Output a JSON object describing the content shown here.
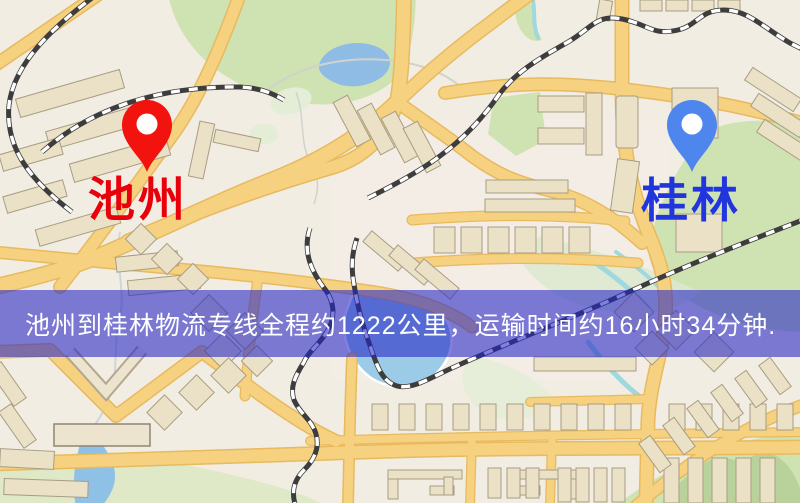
{
  "map": {
    "pins": [
      {
        "id": "origin",
        "label": "池州",
        "pin_color": "#f2130e",
        "label_color": "#e8000b"
      },
      {
        "id": "destination",
        "label": "桂林",
        "pin_color": "#4e86ee",
        "label_color": "#2135dd"
      }
    ],
    "palette": {
      "background": "#f2ede3",
      "road_fill": "#f6d180",
      "road_border": "#e7ba60",
      "park": "#cfe2b2",
      "water": "#8fbce4",
      "building": "#eae1c6",
      "railway": "#3d3d3d"
    }
  },
  "banner": {
    "text": "池州到桂林物流专线全程约1222公里，运输时间约16小时34分钟.",
    "overlay_color": "#2525c6",
    "text_color": "#ffffff"
  }
}
